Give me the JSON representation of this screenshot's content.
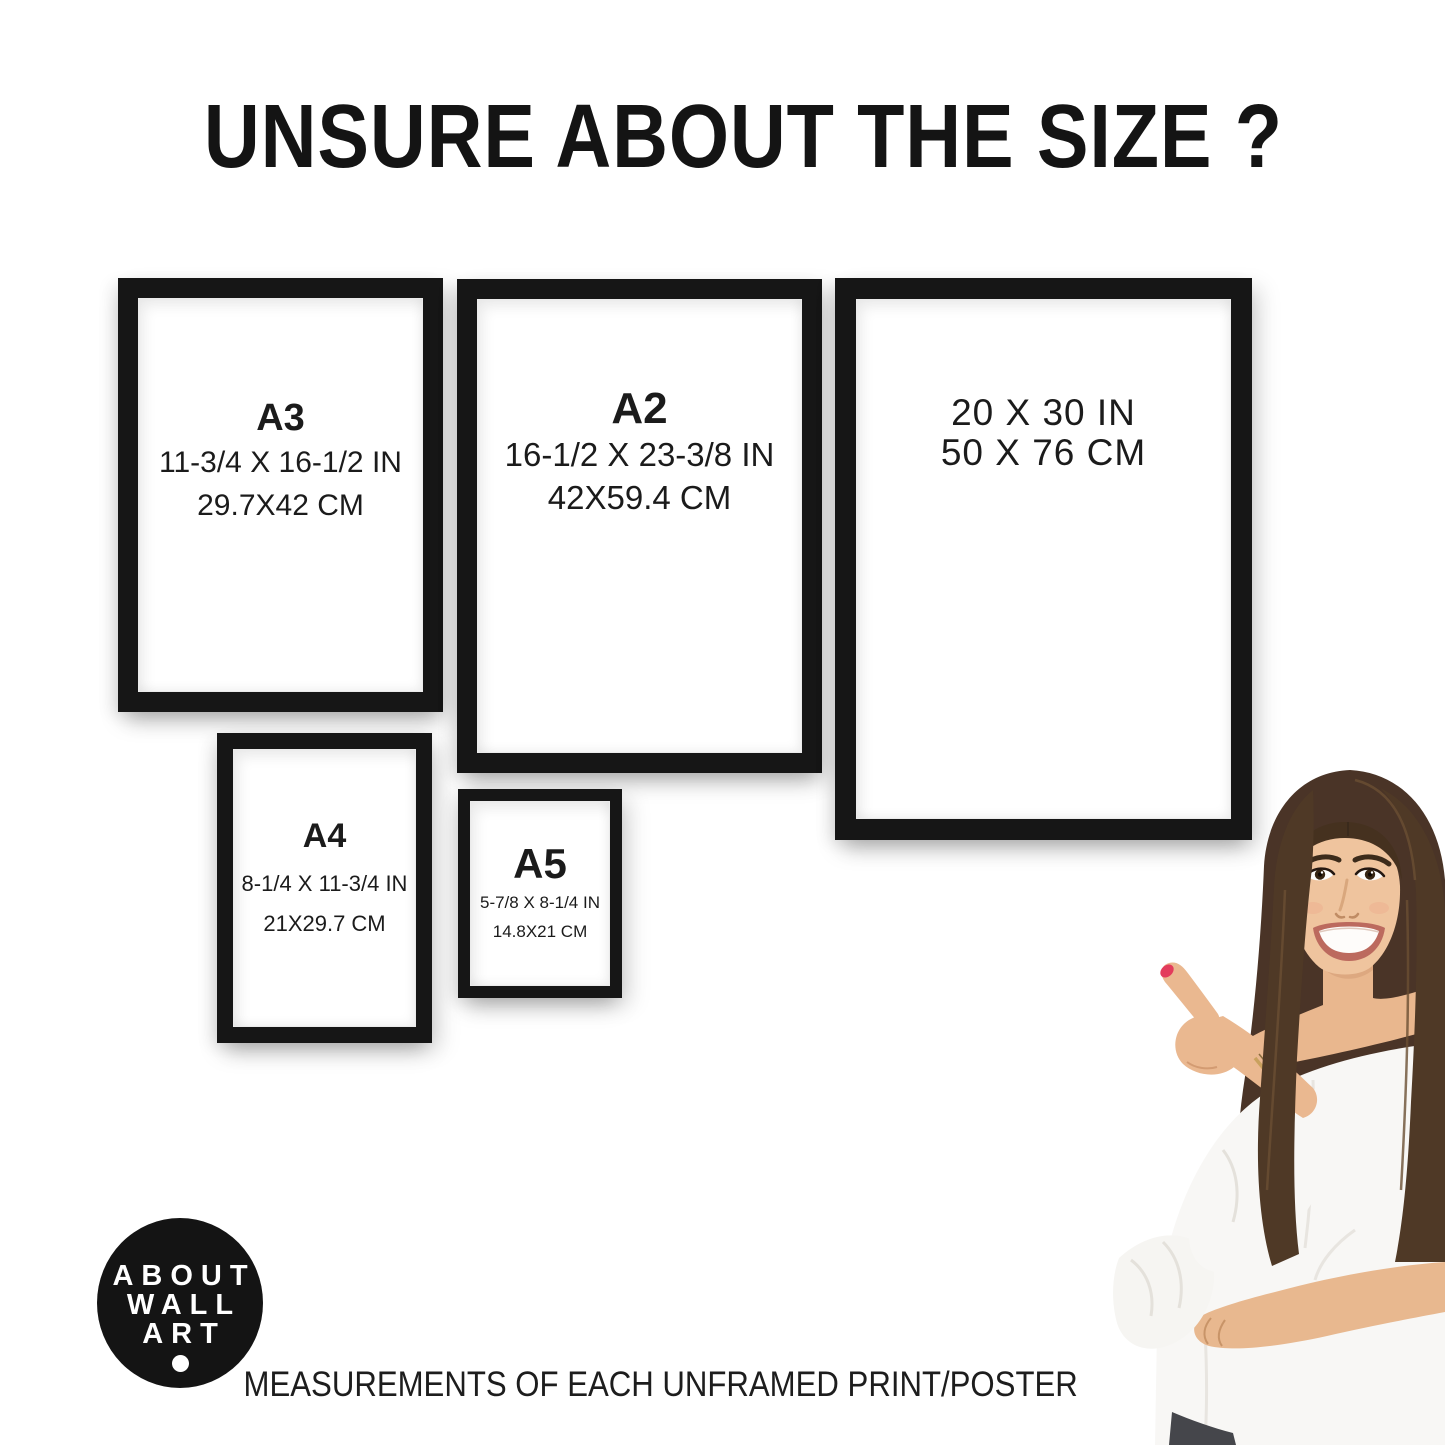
{
  "title": "UNSURE ABOUT THE SIZE ?",
  "frames": [
    {
      "size_label": "A3",
      "inches": "11-3/4 X 16-1/2 IN",
      "centimeters": "29.7X42 CM"
    },
    {
      "size_label": "A2",
      "inches": "16-1/2 X 23-3/8 IN",
      "centimeters": "42X59.4 CM"
    },
    {
      "size_label": "",
      "inches": "20 X 30 IN",
      "centimeters": "50 X 76 CM"
    },
    {
      "size_label": "A4",
      "inches": "8-1/4 X 11-3/4 IN",
      "centimeters": "21X29.7 CM"
    },
    {
      "size_label": "A5",
      "inches": "5-7/8 X 8-1/4 IN",
      "centimeters": "14.8X21 CM"
    }
  ],
  "logo": {
    "line1": "ABOUT",
    "line2": "WALL",
    "line3": "ART"
  },
  "caption": "MEASUREMENTS OF EACH UNFRAMED PRINT/POSTER",
  "colors": {
    "background": "#ffffff",
    "frame_black": "#161616",
    "text": "#1a1a1a",
    "logo_bg": "#141414",
    "logo_text": "#ffffff",
    "nail_red": "#e33c5c"
  }
}
